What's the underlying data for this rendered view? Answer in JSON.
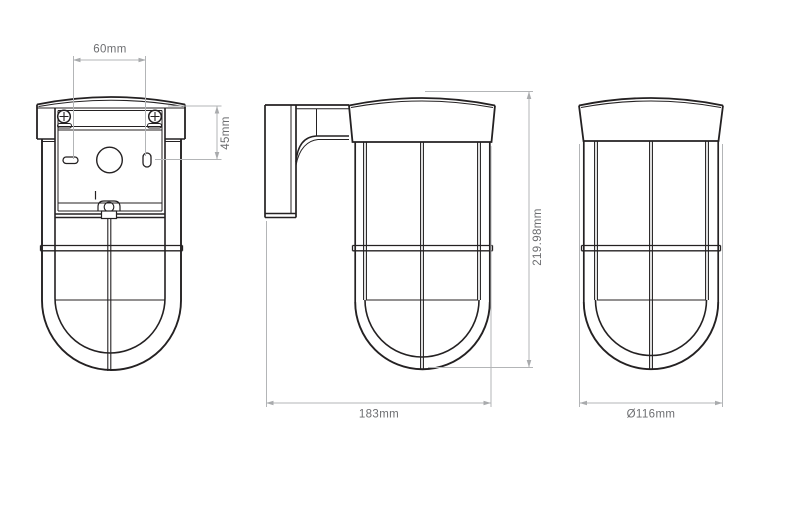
{
  "drawing": {
    "subject": "caged-wall-light-technical-drawing",
    "colors": {
      "background": "#ffffff",
      "line": "#242122",
      "dimension_line": "#b3b5b7",
      "dimension_text": "#6d6e71"
    },
    "dimensions": {
      "screw_spacing": "60mm",
      "plate_offset": "45mm",
      "height": "219.98mm",
      "depth": "183mm",
      "diameter": "Ø116mm"
    }
  }
}
